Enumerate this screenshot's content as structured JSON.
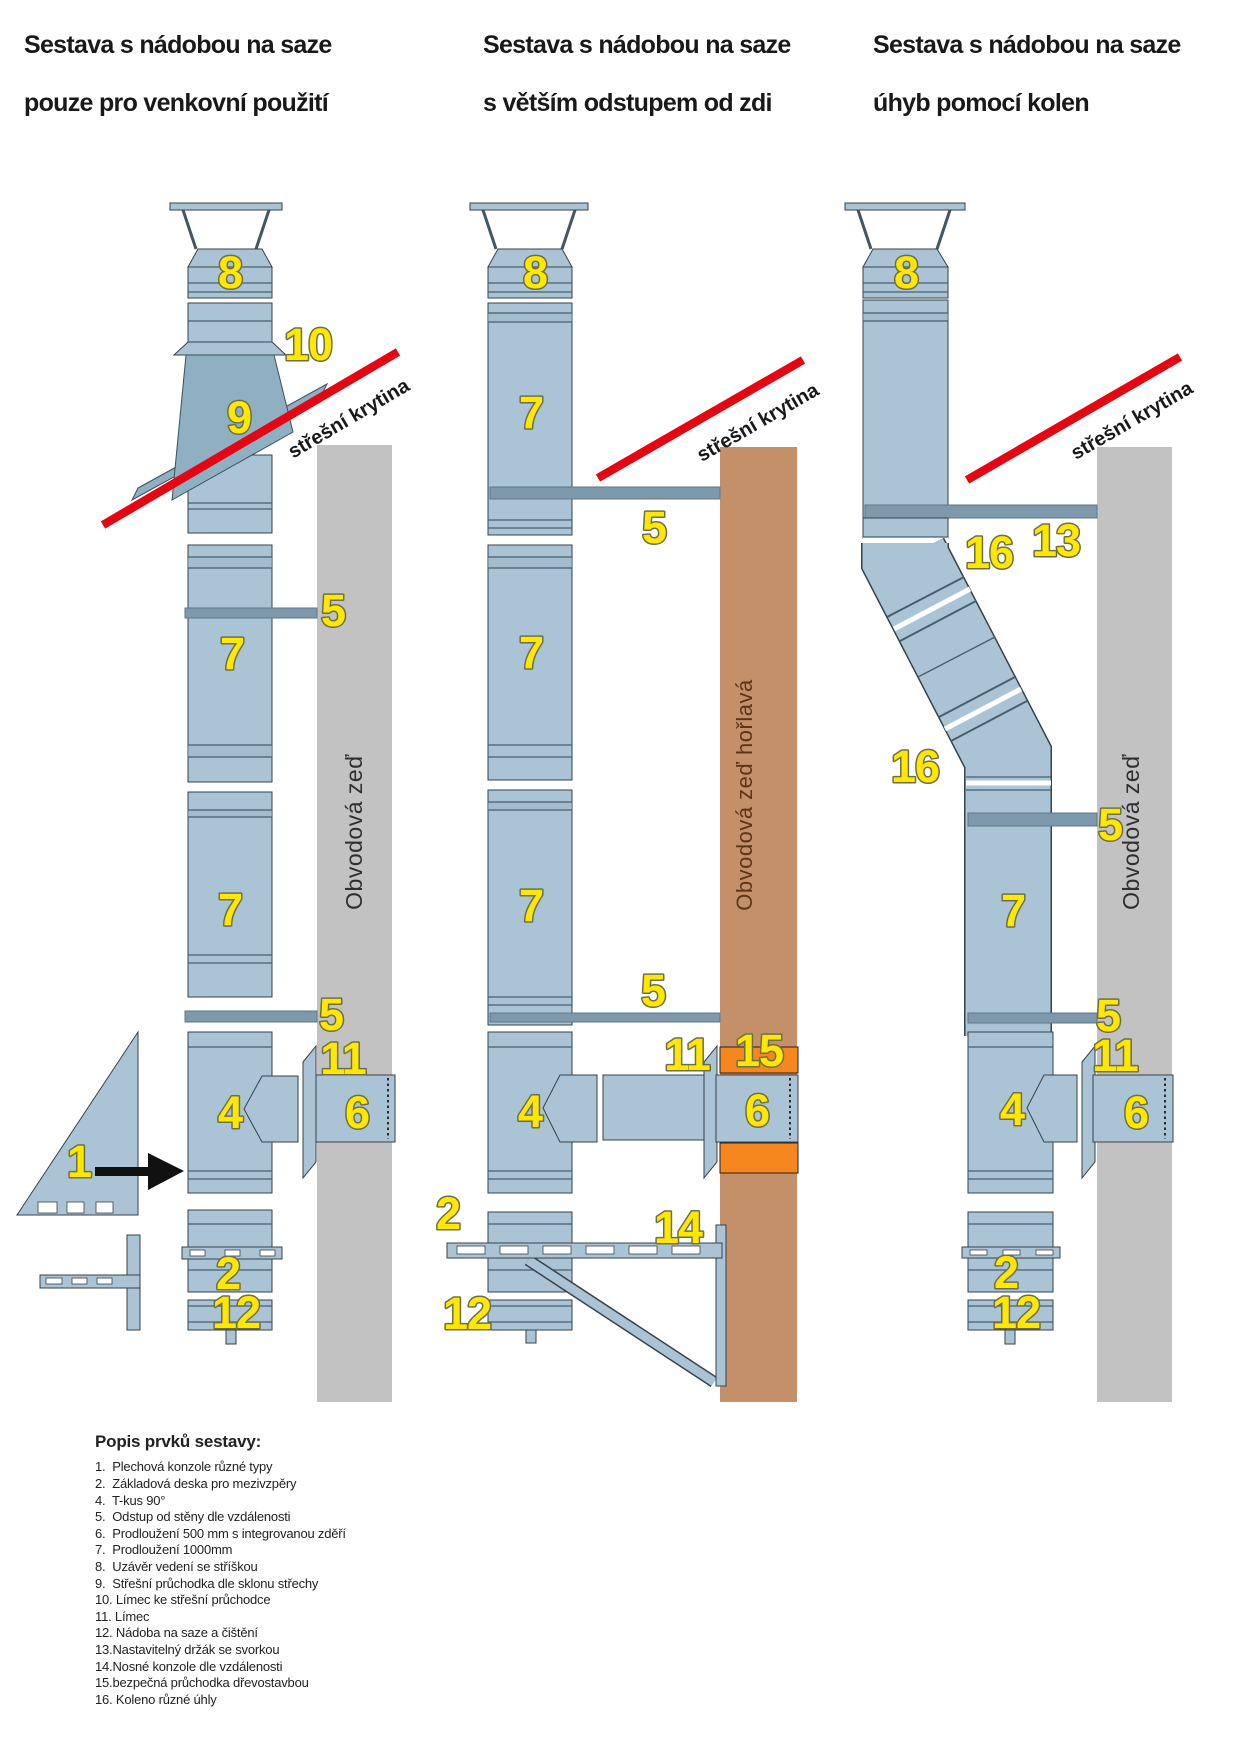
{
  "titles": [
    {
      "line1": "Sestava s nádobou na saze",
      "line2": "pouze pro venkovní použití"
    },
    {
      "line1": "Sestava s nádobou na saze",
      "line2": "s větším odstupem od zdi"
    },
    {
      "line1": "Sestava s nádobou na saze",
      "line2": "úhyb pomocí kolen"
    }
  ],
  "roof_label": "střešní krytina",
  "walls": {
    "left": "Obvodová zeď",
    "middle": "Obvodová zeď hořlavá",
    "right": "Obvodová zeď"
  },
  "parts": {
    "p1": "1",
    "p2": "2",
    "p4": "4",
    "p5": "5",
    "p6": "6",
    "p7": "7",
    "p8": "8",
    "p9": "9",
    "p10": "10",
    "p11": "11",
    "p12": "12",
    "p13": "13",
    "p14": "14",
    "p15": "15",
    "p16": "16"
  },
  "legend": {
    "heading": "Popis prvků sestavy:",
    "items": [
      "1.  Plechová konzole různé typy",
      "2.  Základová deska pro mezivzpěry",
      "4.  T-kus 90°",
      "5.  Odstup od stěny dle vzdálenosti",
      "6.  Prodloužení 500 mm s integrovanou zděří",
      "7.  Prodloužení 1000mm",
      "8.  Uzávěr vedení se stříškou",
      "9.  Střešní průchodka dle sklonu střechy",
      "10. Límec ke střešní průchodce",
      "11. Límec",
      "12. Nádoba na saze a čištění",
      "13.Nastavitelný držák se svorkou",
      "14.Nosné konzole dle vzdálenosti",
      "15.bezpečná průchodka dřevostavbou",
      "16. Koleno různé úhly"
    ]
  },
  "colors": {
    "pipe": "#aac4d6",
    "flashing": "#8fafc2",
    "wallgray": "#c2c2c2",
    "wallwood": "#c4906a",
    "orange": "#f6871f",
    "red": "#e30613",
    "yellow": "#ffe800",
    "bar": "#7e99ab"
  }
}
